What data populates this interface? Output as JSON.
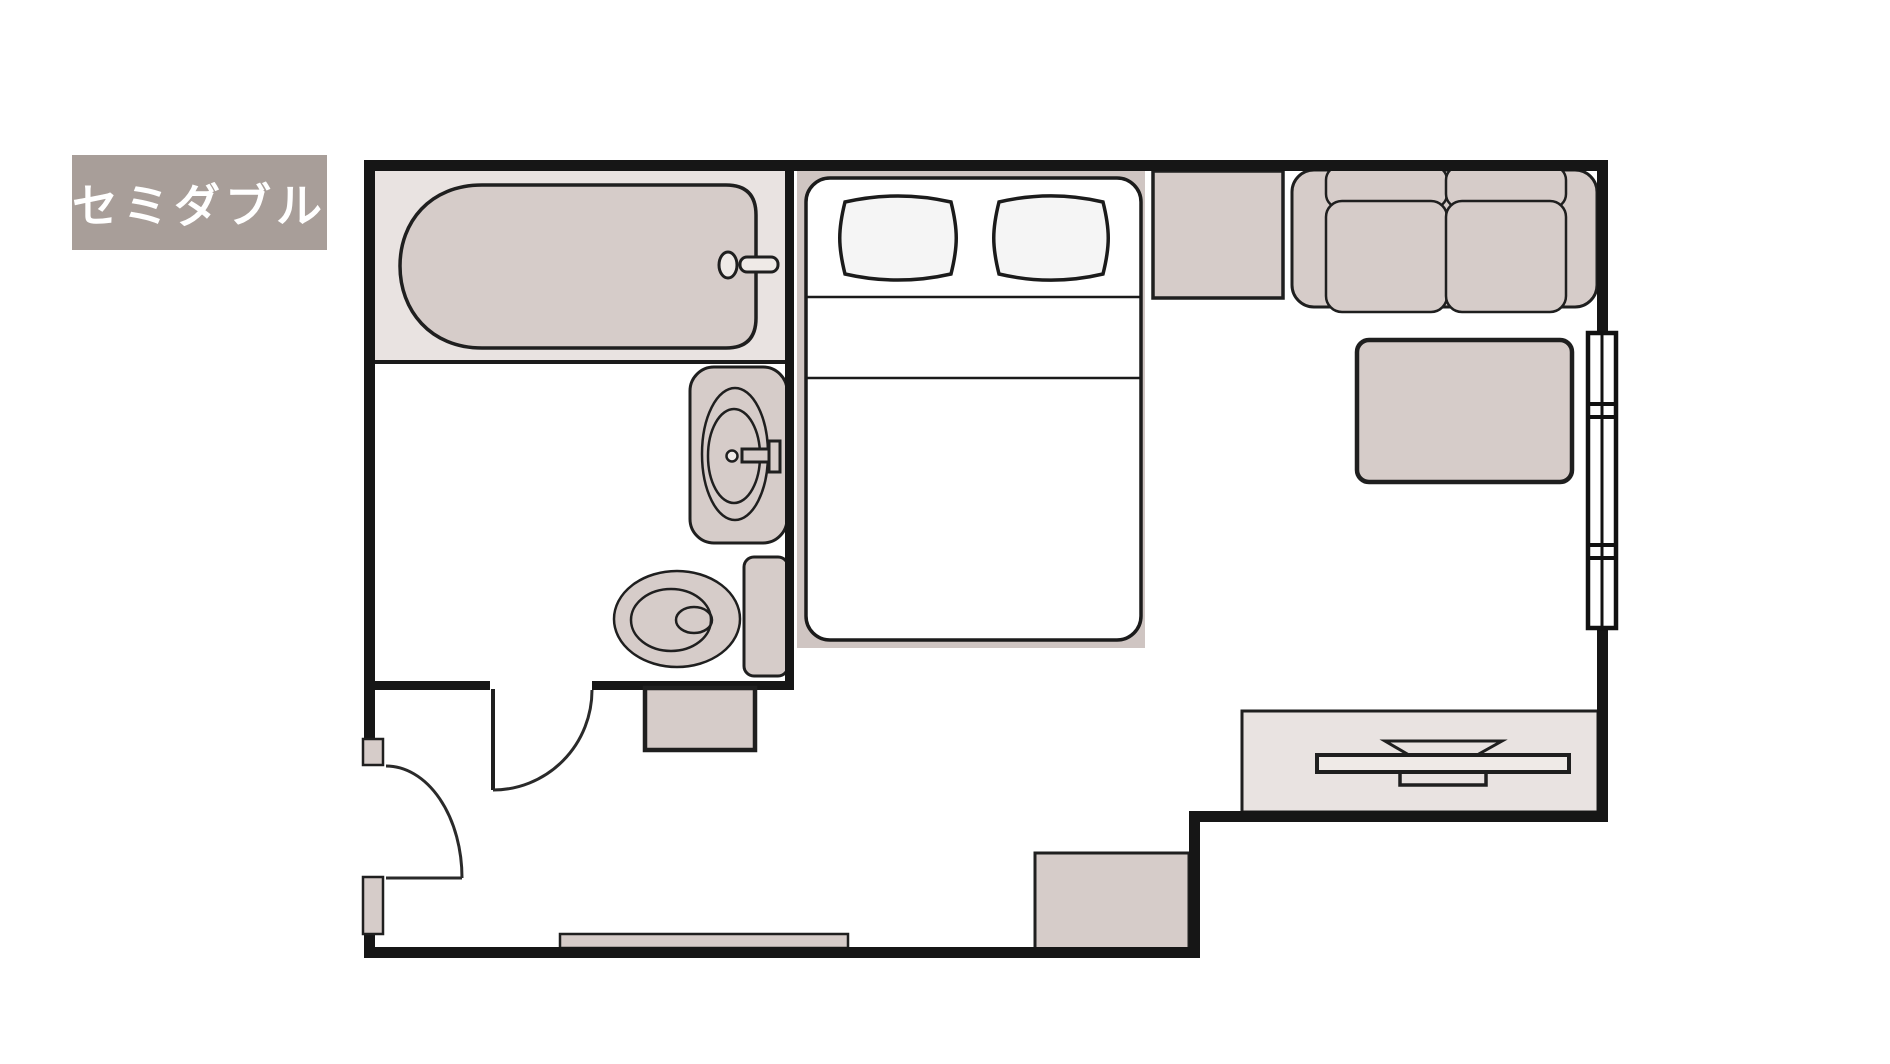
{
  "room_label": {
    "text": "セミダブル"
  },
  "colors": {
    "wall": "#161616",
    "line": "#1f1f1f",
    "furn": "#d6ccc9",
    "zone": "#e9e3e1",
    "platform": "#cfc5c2",
    "pillow": "#f5f5f5",
    "board": "#efeae7",
    "paper": "#ffffff",
    "labelBg": "#a89e99",
    "labelText": "#ffffff"
  },
  "plan": {
    "type": "hotel-room-floor-plan",
    "rooms": [
      {
        "name": "bathroom",
        "features": [
          "bathtub",
          "bathtub-faucet",
          "washbasin",
          "washbasin-faucet",
          "toilet",
          "bathroom-door"
        ]
      },
      {
        "name": "bedroom-living",
        "features": [
          "semi-double-bed",
          "pillow",
          "pillow",
          "counter",
          "sofa",
          "low-table",
          "window",
          "tv",
          "tv-board"
        ]
      },
      {
        "name": "entrance",
        "features": [
          "entrance-door",
          "storage-cabinet",
          "bench",
          "floor-mat"
        ]
      }
    ]
  }
}
